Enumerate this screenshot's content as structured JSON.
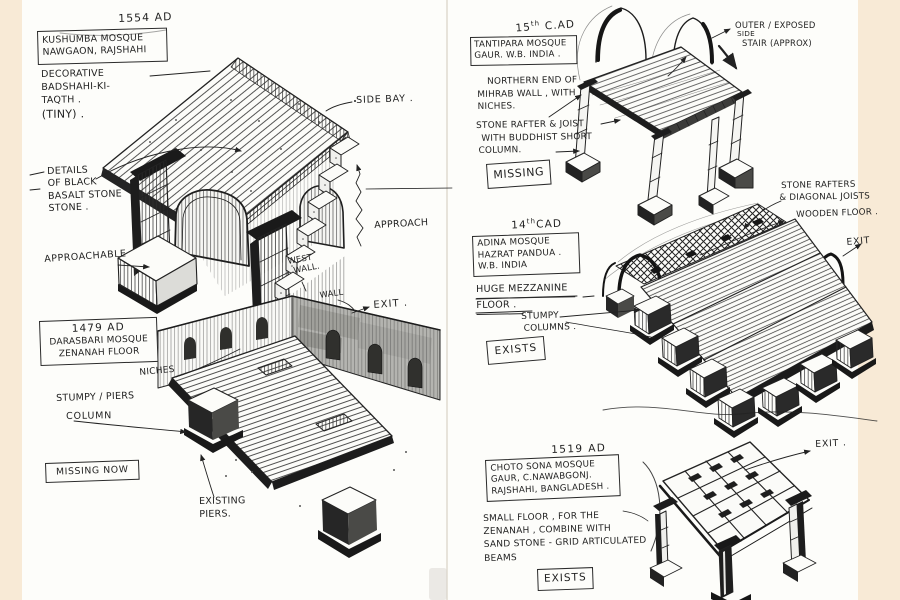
{
  "palette": {
    "paper": "#fdfdfa",
    "desk": "#f8ead6",
    "ink": "#1f1f1f",
    "marker": "#a9a9a5"
  },
  "left_page": {
    "kushumba": {
      "year": "1554 AD",
      "title": [
        "KUSHUMBA MOSQUE",
        "NAWGAON, RAJSHAHI"
      ],
      "notes": [
        "DECORATIVE",
        "BADSHAHI-KI-",
        "TAQTH .",
        "(TINY) ."
      ],
      "side_bay": "SIDE BAY .",
      "details": [
        "DETAILS",
        "OF BLACK",
        "BASALT STONE",
        "STONE ."
      ],
      "approachable": "APPROACHABLE",
      "approach": "APPROACH"
    },
    "darasbari": {
      "year": "1479 AD",
      "title": [
        "DARASBARI MOSQUE",
        "ZENANAH FLOOR"
      ],
      "west_wall": [
        "WEST",
        "WALL."
      ],
      "wall": "WALL",
      "exit": "EXIT .",
      "niches": "NICHES",
      "stumpy_piers": "STUMPY / PIERS",
      "column": "COLUMN",
      "status": "MISSING NOW",
      "existing_piers": [
        "EXISTING",
        "PIERS."
      ]
    }
  },
  "right_page": {
    "tantipara": {
      "century": {
        "num": "15",
        "sup": "th",
        "era": "C.AD"
      },
      "title": [
        "TANTIPARA MOSQUE",
        "GAUR. W.B. INDIA ."
      ],
      "mihrab_note": [
        "NORTHERN END OF",
        "MIHRAB WALL , WITH",
        "NICHES."
      ],
      "rafter_note": [
        "STONE RAFTER & JOIST",
        "WITH BUDDHIST SHORT",
        "COLUMN."
      ],
      "stair_note": [
        "OUTER / EXPOSED",
        "SIDE",
        "STAIR (APPROX)"
      ],
      "status": "MISSING"
    },
    "adina": {
      "century": {
        "num": "14",
        "sup": "th",
        "era": "CAD"
      },
      "title": [
        "ADINA MOSQUE",
        "HAZRAT PANDUA .",
        "W.B. INDIA"
      ],
      "mezzanine": [
        "HUGE MEZZANINE",
        "FLOOR ."
      ],
      "stumpy": [
        "STUMPY",
        "COLUMNS ."
      ],
      "rafters": [
        "STONE RAFTERS",
        "& DIAGONAL JOISTS"
      ],
      "wooden_floor": "WOODEN FLOOR .",
      "exit": "EXIT",
      "status": "EXISTS"
    },
    "choto_sona": {
      "year": "1519 AD",
      "title": [
        "CHOTO SONA MOSQUE",
        "GAUR, C.NAWABGONJ.",
        "RAJSHAHI, BANGLADESH ."
      ],
      "note": [
        "SMALL FLOOR , FOR THE",
        "ZENANAH , COMBINE WITH",
        "SAND STONE - GRID ARTICULATED",
        "BEAMS"
      ],
      "status": "EXISTS",
      "exit": "EXIT ."
    }
  }
}
